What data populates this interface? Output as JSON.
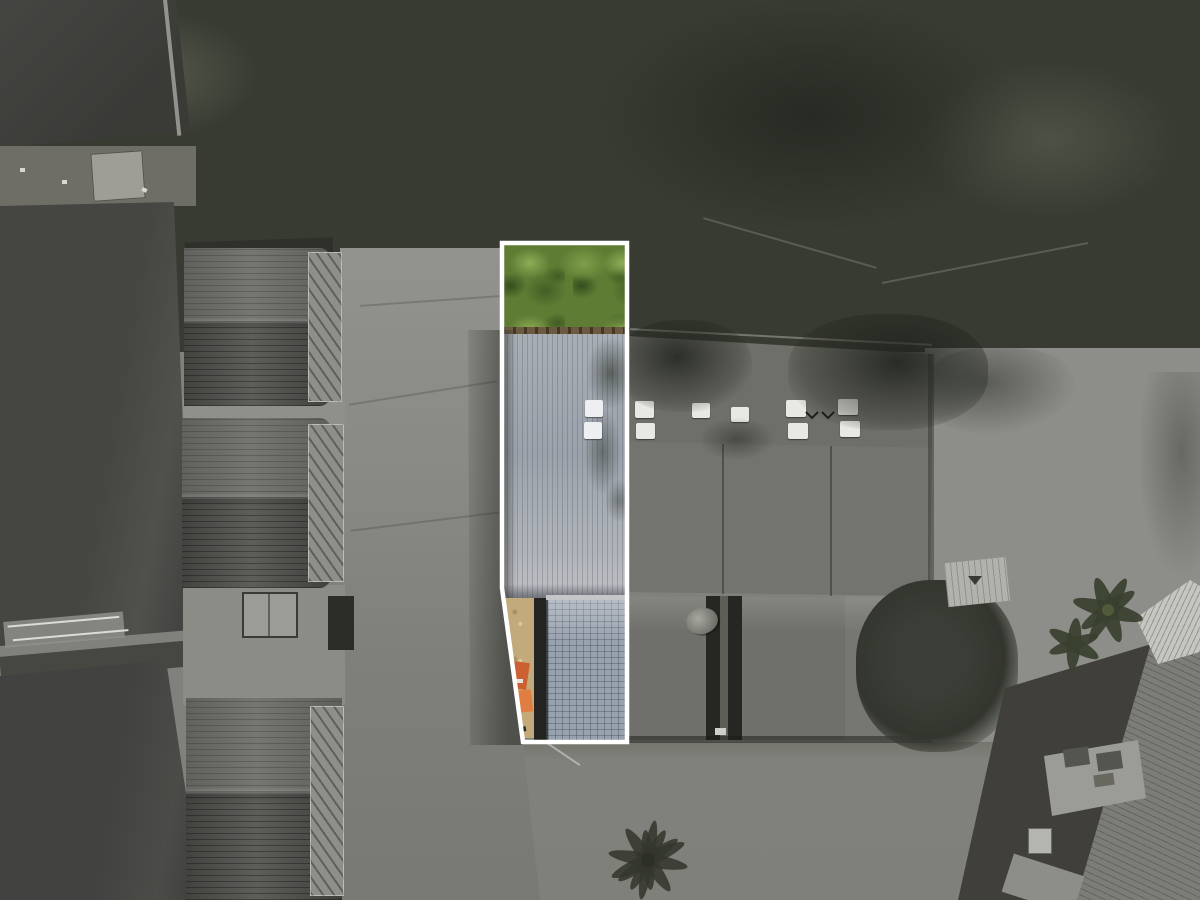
{
  "scene": {
    "type": "aerial-drone-photograph",
    "description": "Top-down aerial photo of a row of terrace houses and a long shared building; the image is desaturated grayscale except a narrow property lot highlighted by a white boundary outline, shown in full color (green tree canopy, pale blue-gray metal roof with two skylights, sandy side path with orange equipment, blue-gray tiled lower roof).",
    "saturation_note": "color only inside highlighted lot"
  },
  "lot_outline": {
    "points": "502,243 627,243 627,742 523,742 502,588",
    "stroke": "#ffffff",
    "stroke_width": 4.5
  },
  "palette": {
    "tree_mid": "#383b32",
    "pavement_light": "#8d8d89",
    "pavement_mid": "#80807c",
    "roof_dark": "#454542",
    "metal_roof": "#73746e",
    "skylight_white": "#e8e8e5",
    "lot_roof": "#a9aeb5",
    "lot_tiles": "#98a1ae",
    "lot_green": "#5e7c33",
    "lot_sand": "#c2aa7b",
    "lot_orange": "#cd6030",
    "outline_white": "#ffffff"
  },
  "skylights": {
    "color": "#e8e8e5",
    "items": [
      {
        "x": 635,
        "y": 401,
        "w": 19,
        "h": 17
      },
      {
        "x": 636,
        "y": 423,
        "w": 19,
        "h": 16
      },
      {
        "x": 692,
        "y": 403,
        "w": 18,
        "h": 15
      },
      {
        "x": 731,
        "y": 407,
        "w": 18,
        "h": 15
      },
      {
        "x": 786,
        "y": 400,
        "w": 20,
        "h": 17
      },
      {
        "x": 788,
        "y": 423,
        "w": 20,
        "h": 16
      },
      {
        "x": 838,
        "y": 399,
        "w": 20,
        "h": 16
      },
      {
        "x": 840,
        "y": 421,
        "w": 20,
        "h": 16
      }
    ]
  },
  "lot_skylights": {
    "color": "#edeff1",
    "items": [
      {
        "x": 585,
        "y": 400,
        "w": 18,
        "h": 17
      },
      {
        "x": 584,
        "y": 422,
        "w": 18,
        "h": 17
      }
    ]
  },
  "birds": {
    "paths": "M806,412 l6,6 l6,-6 M822,412 l6,6 l6,-6",
    "stroke": "#1e1e1c"
  }
}
